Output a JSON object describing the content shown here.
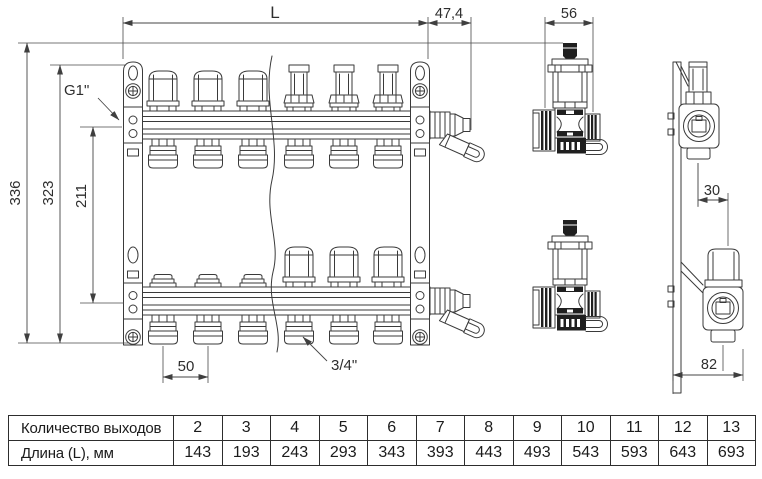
{
  "drawing": {
    "dim_labels": {
      "L": "L",
      "offset474": "47,4",
      "vent56": "56",
      "inlet_thread": "G1\"",
      "h336": "336",
      "h323": "323",
      "h211": "211",
      "spacing50": "50",
      "outlet_thread": "3/4\"",
      "d30": "30",
      "d82": "82"
    },
    "colors": {
      "line": "#3a3a3a",
      "dark_fill": "#1f1f1f",
      "background": "#ffffff"
    }
  },
  "table": {
    "rows": [
      {
        "label": "Количество выходов",
        "values": [
          "2",
          "3",
          "4",
          "5",
          "6",
          "7",
          "8",
          "9",
          "10",
          "11",
          "12",
          "13"
        ]
      },
      {
        "label": "Длина (L), мм",
        "values": [
          "143",
          "193",
          "243",
          "293",
          "343",
          "393",
          "443",
          "493",
          "543",
          "593",
          "643",
          "693"
        ]
      }
    ]
  }
}
